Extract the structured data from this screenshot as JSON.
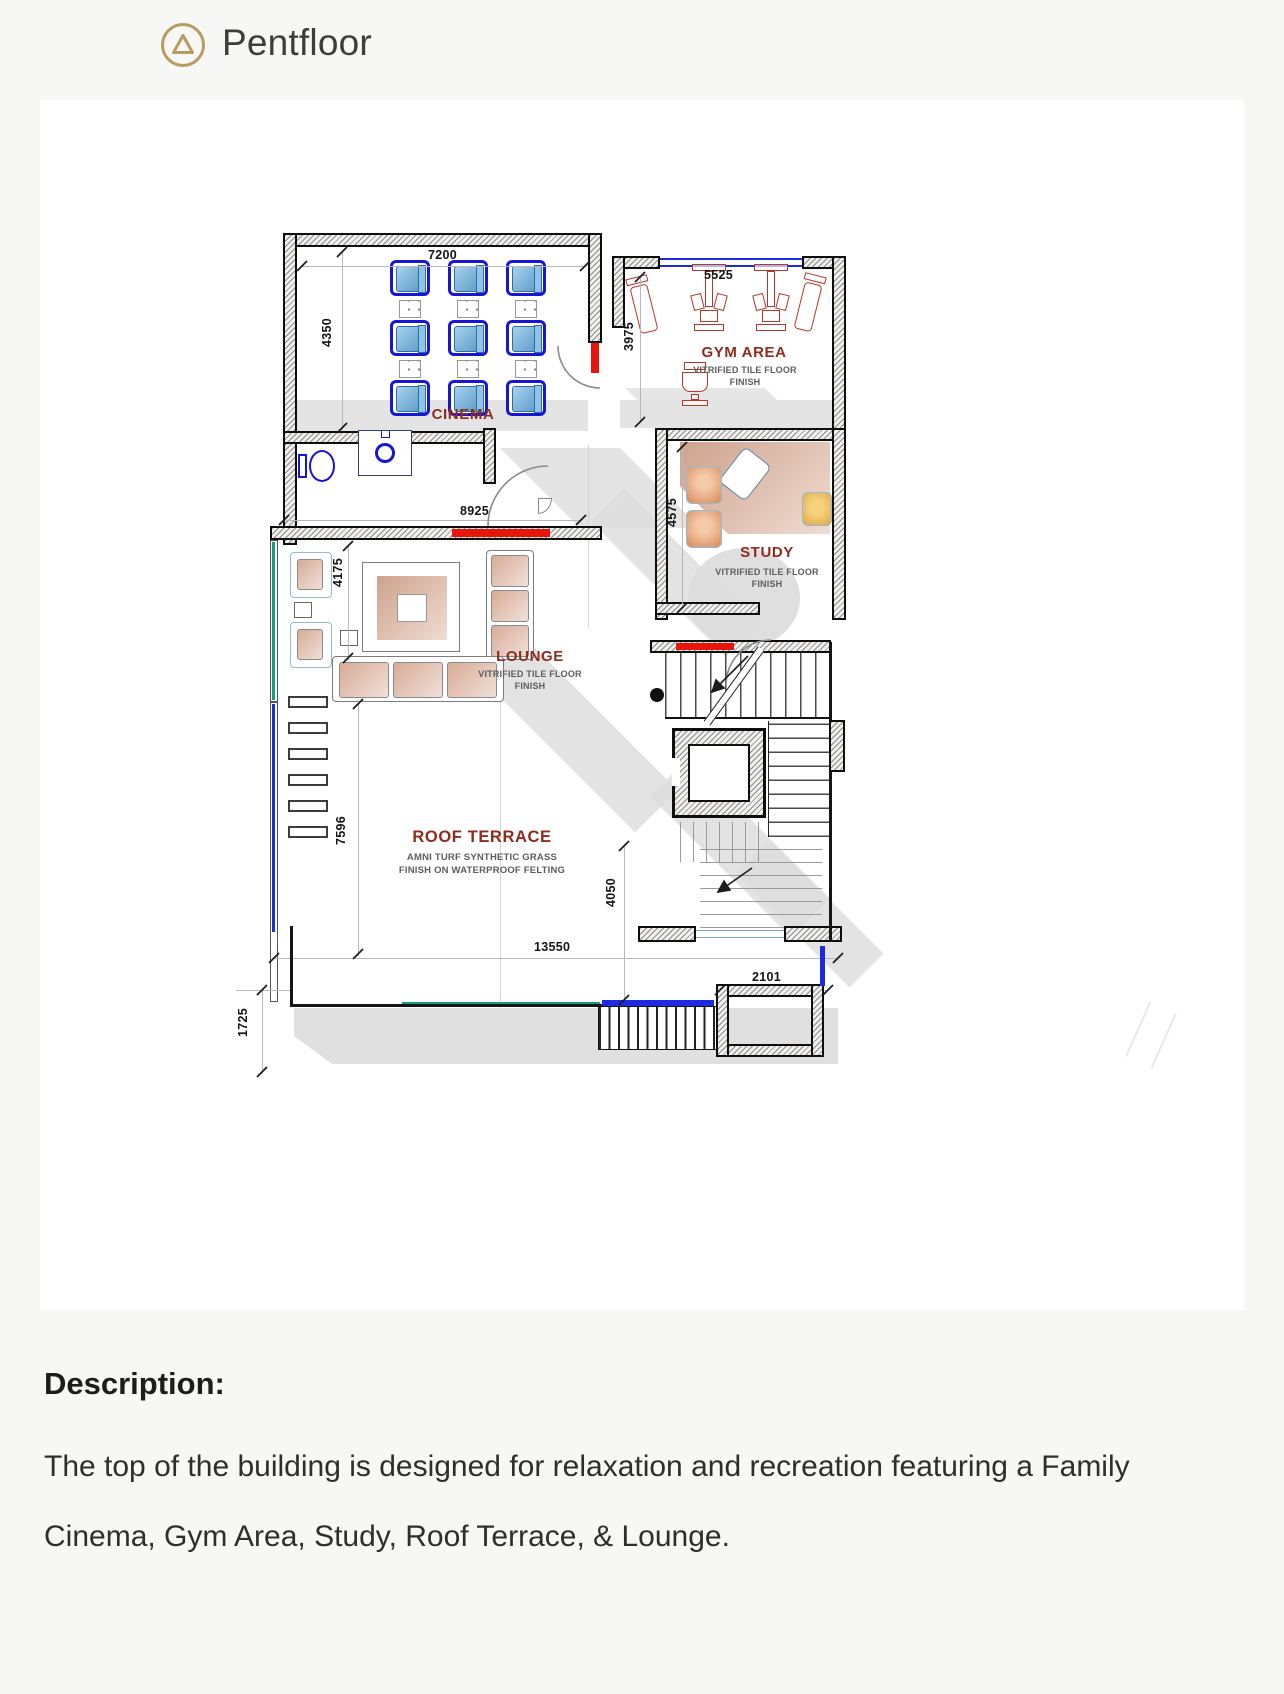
{
  "header": {
    "title": "Pentfloor"
  },
  "plan": {
    "rooms": {
      "cinema": {
        "label": "CINEMA"
      },
      "gym": {
        "label": "GYM AREA",
        "finish": "VITRIFIED TILE FLOOR FINISH"
      },
      "study": {
        "label": "STUDY",
        "finish": "VITRIFIED TILE FLOOR FINISH"
      },
      "lounge": {
        "label": "LOUNGE",
        "finish": "VITRIFIED TILE FLOOR FINISH"
      },
      "terrace": {
        "label": "ROOF TERRACE",
        "finish": "AMNI TURF SYNTHETIC GRASS FINISH ON WATERPROOF FELTING"
      }
    },
    "dims": {
      "cinema_w": "7200",
      "cinema_h": "4350",
      "gym_w": "5525",
      "gym_h": "3975",
      "study_h": "4575",
      "lounge_w": "8925",
      "lounge_h": "4175",
      "terrace_h": "7596",
      "terrace_mid_h": "4050",
      "terrace_w": "13550",
      "balcony_w": "2101",
      "setback_h": "1725"
    },
    "colors": {
      "room_label": "#8f2c1e",
      "seat_blue": "#1716d6",
      "gym_red": "#b5362a",
      "window_blue": "#1d2ae0",
      "window_teal": "#12a07b",
      "door_red": "#e8150a",
      "accent_gold": "#b99a5f",
      "shadow": "#dcdcdc"
    }
  },
  "description": {
    "heading": "Description:",
    "body": "The top of the building is designed for relaxation and recreation featuring a Family Cinema, Gym Area, Study, Roof Terrace, & Lounge."
  }
}
